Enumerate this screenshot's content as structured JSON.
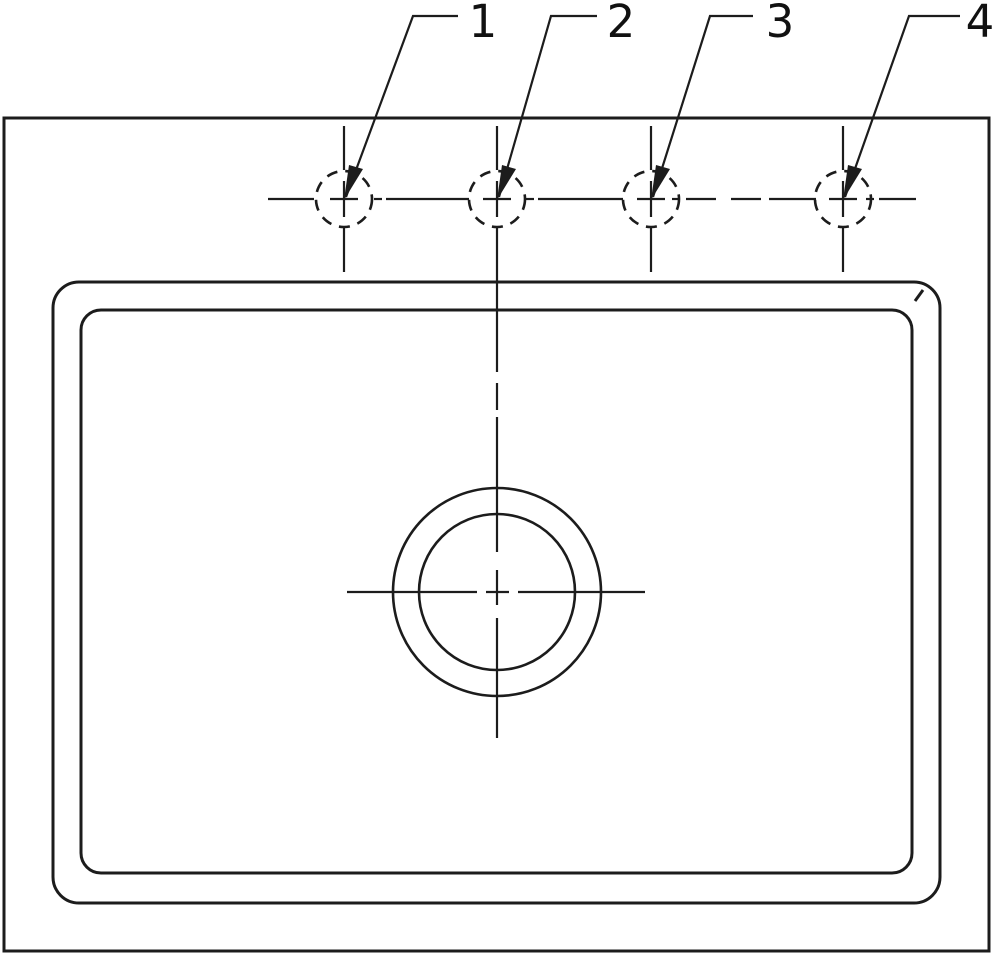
{
  "figure": {
    "kind": "technical-line-drawing",
    "description": "Top plan view of a rectangular sink deck with four dashed faucet mounting holes on a horizontal centerline, numbered leader callouts 1-4, a rounded-rectangle basin rim (outer and inner), and a concentric-circle center drain with crosshair centerlines",
    "background_color": "#ffffff",
    "line_color": "#1c1c1c",
    "label_color": "#111111",
    "labels": {
      "hole1": "1",
      "hole2": "2",
      "hole3": "3",
      "hole4": "4"
    }
  }
}
